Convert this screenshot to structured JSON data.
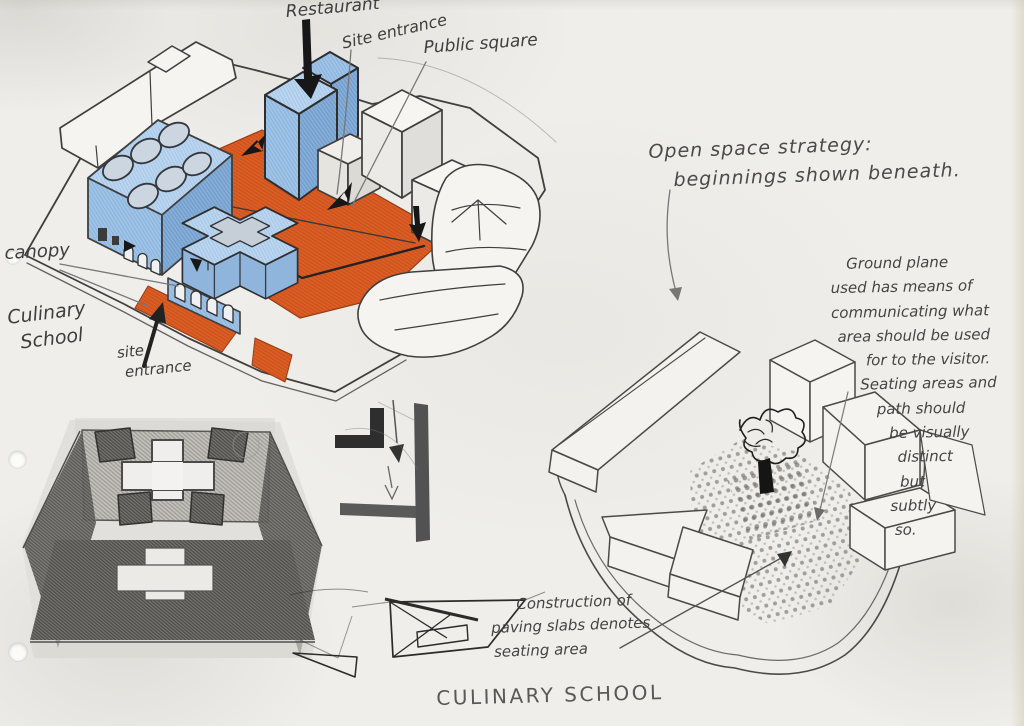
{
  "page": {
    "title": "CULINARY SCHOOL"
  },
  "palette": {
    "paper": "#efeeea",
    "pencil_gray": "#555555",
    "ink_black": "#1c1c1c",
    "building_blue": "#a5c8e8",
    "square_orange": "#dd5c24"
  },
  "labels": {
    "restaurant": "Restaurant",
    "site_entrance_top": "Site entrance",
    "public_square": "Public square",
    "canopy": "canopy",
    "culinary_school": {
      "line1": "Culinary",
      "line2": "School"
    },
    "site_entrance_left": {
      "line1": "site",
      "line2": "entrance"
    }
  },
  "notes": {
    "open_space": {
      "line1": "Open space strategy:",
      "line2": "beginnings shown beneath."
    },
    "ground_plane": {
      "lines": [
        "Ground plane",
        "used has means of",
        "communicating what",
        "area should be used",
        "for to the visitor.",
        "Seating areas and",
        "path should",
        "be visually",
        "distinct",
        "but",
        "subtly",
        "so."
      ]
    },
    "construction": {
      "lines": [
        "Construction of",
        "paving slabs denotes",
        "seating area"
      ]
    }
  }
}
